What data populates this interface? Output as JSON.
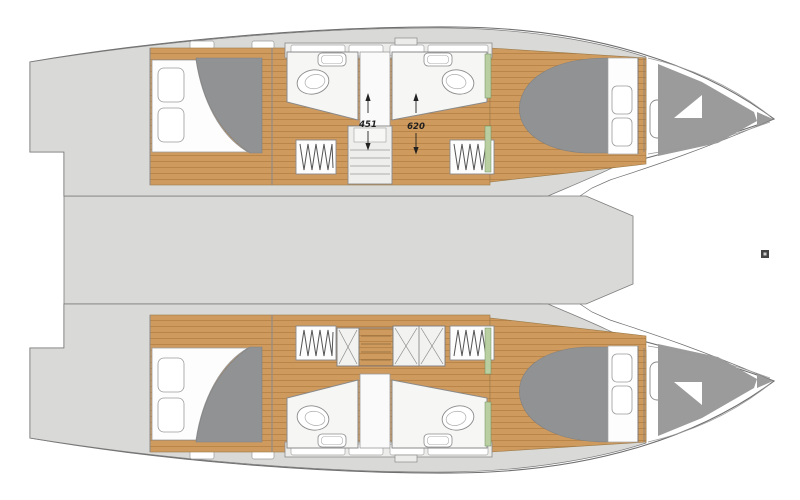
{
  "plan": {
    "kind": "catamaran-deck-plan",
    "labels": {
      "dim_aft": "451",
      "dim_fwd": "620"
    },
    "features": [
      "port-hull",
      "starboard-hull",
      "bridgedeck",
      "aft-double-berth",
      "forward-double-berth",
      "pillows",
      "bathroom",
      "toilet",
      "washbasin",
      "wardrobe",
      "companionway-stairs",
      "zigzag-steps",
      "hatch-x-cover",
      "bow-storage-locker",
      "deck-hatch",
      "stray-marker"
    ],
    "colors": {
      "background": "#ffffff",
      "hull_deck": "#d9d9d7",
      "wood": "#cf9a5e",
      "wood_line": "#b07c40",
      "mattress": "#909294",
      "storage": "#9b9b9b",
      "outline": "#6f6f6f",
      "wall": "#8a8a8a",
      "accent_green": "#b9cfa2",
      "label": "#1f1f1f"
    }
  }
}
